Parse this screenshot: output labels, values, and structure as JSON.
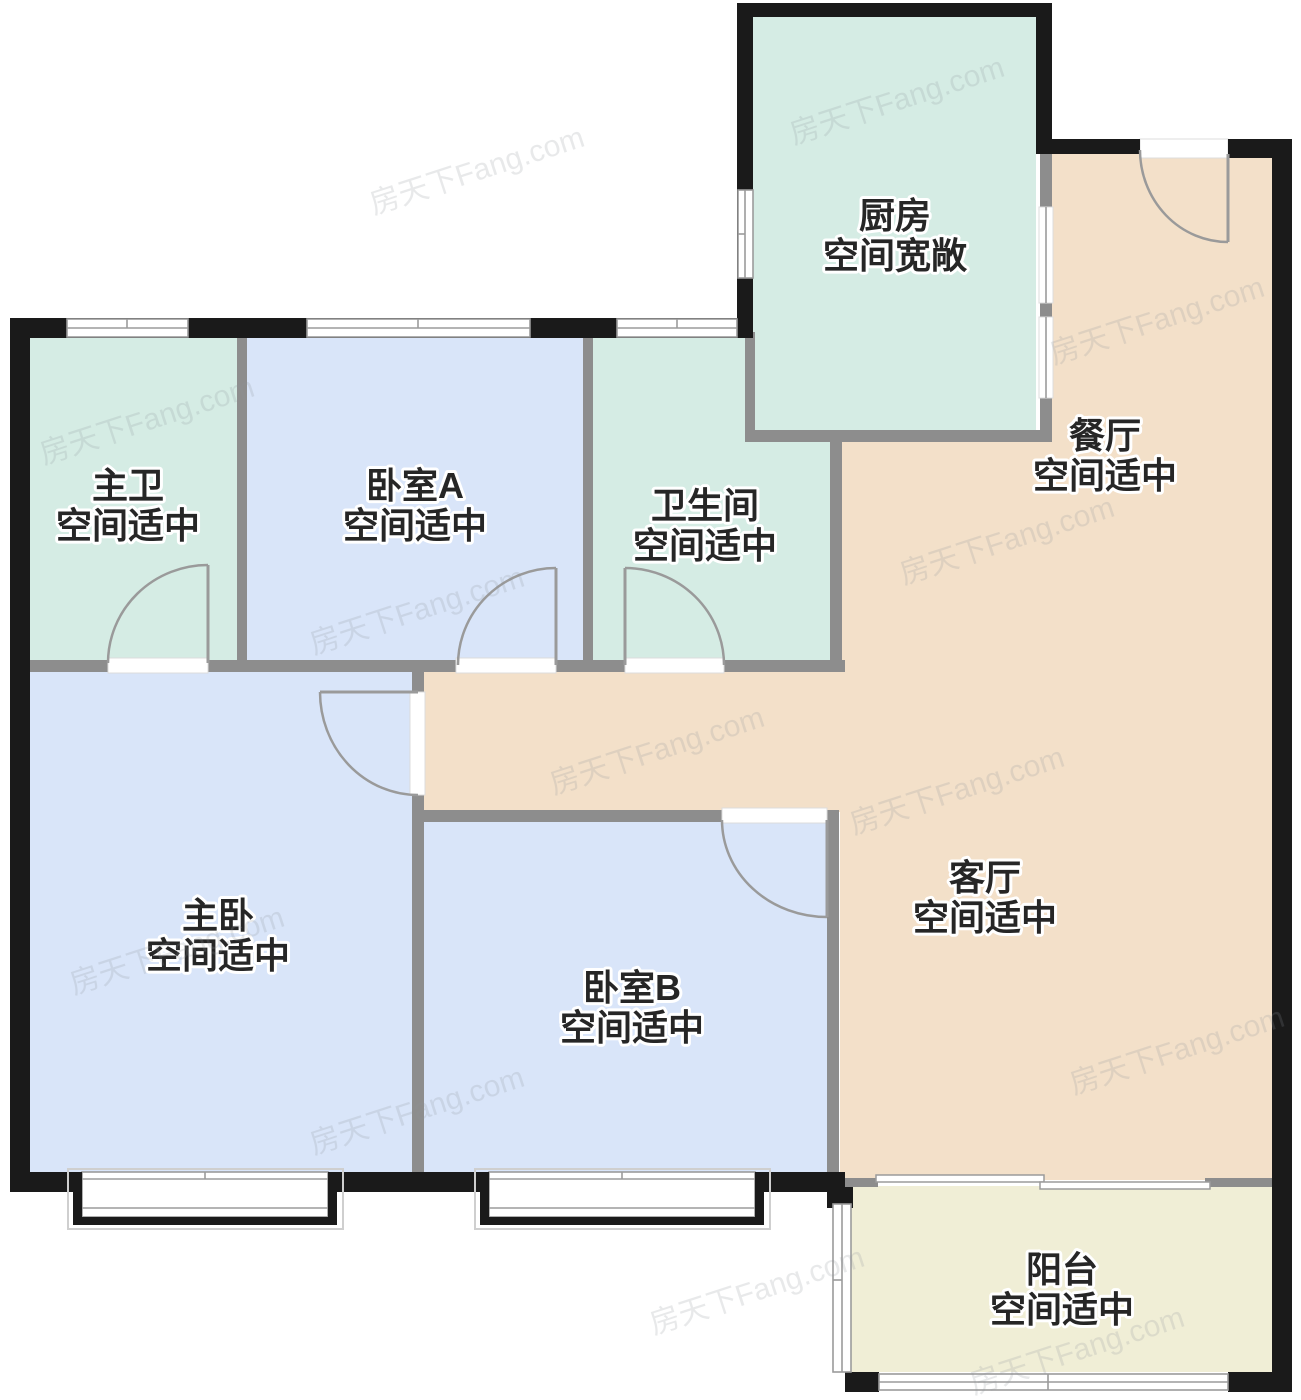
{
  "floorplan": {
    "rooms": [
      {
        "id": "kitchen",
        "name": "厨房",
        "desc": "空间宽敞"
      },
      {
        "id": "dining",
        "name": "餐厅",
        "desc": "空间适中"
      },
      {
        "id": "master-bath",
        "name": "主卫",
        "desc": "空间适中"
      },
      {
        "id": "bedroom-a",
        "name": "卧室A",
        "desc": "空间适中"
      },
      {
        "id": "bathroom",
        "name": "卫生间",
        "desc": "空间适中"
      },
      {
        "id": "master-bedroom",
        "name": "主卧",
        "desc": "空间适中"
      },
      {
        "id": "bedroom-b",
        "name": "卧室B",
        "desc": "空间适中"
      },
      {
        "id": "living",
        "name": "客厅",
        "desc": "空间适中"
      },
      {
        "id": "balcony",
        "name": "阳台",
        "desc": "空间适中"
      }
    ],
    "watermark": {
      "text": "房天下Fang.com"
    },
    "colors": {
      "wall_exterior": "#1a1a1a",
      "wall_interior": "#8d8d8d",
      "room_mint": "#d5ece4",
      "room_blue": "#d9e5f9",
      "room_peach": "#f3e0c9",
      "room_cream": "#f0eed6",
      "door_arc": "#9a9a9a",
      "window_line": "#9b9b9b",
      "label_fill": "#262626",
      "label_halo": "#ffffff",
      "watermark": "#8e959b"
    }
  }
}
